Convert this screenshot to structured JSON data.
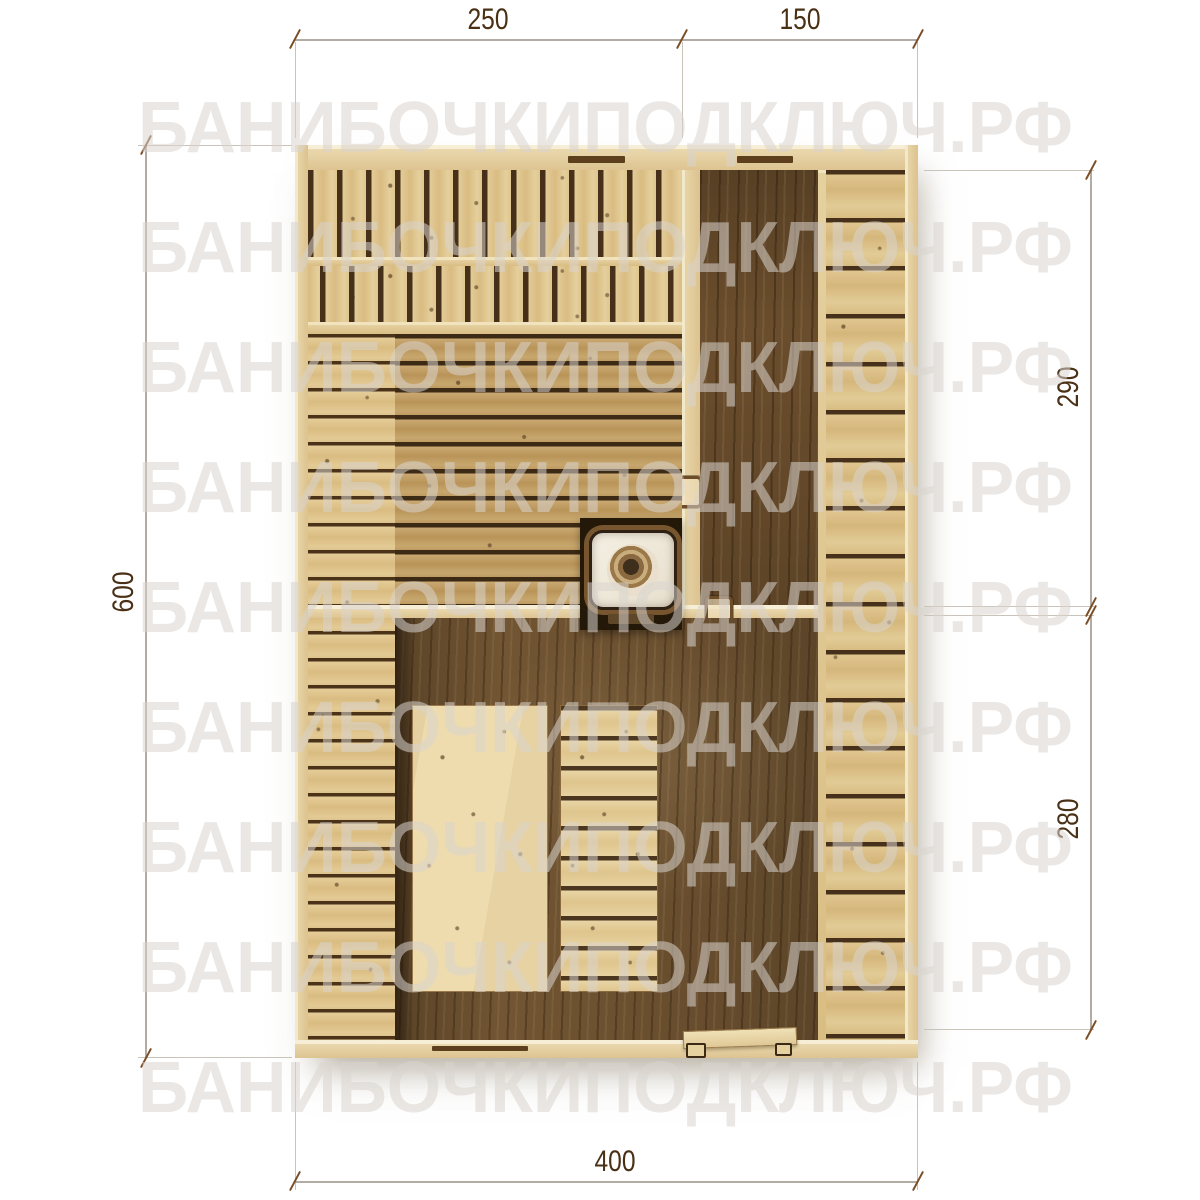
{
  "watermark": {
    "text": "БАНИБОЧКИПОДКЛЮЧ.РФ"
  },
  "dimensions": {
    "top_left": "250",
    "top_right": "150",
    "left": "600",
    "right_upper": "290",
    "right_lower": "280",
    "bottom": "400"
  },
  "colors": {
    "background": "#ffffff",
    "watermark_gray": "#e8e6e2",
    "dimension_line": "#b2aca2",
    "dimension_tick": "#7a4e26",
    "dimension_text": "#4a3015",
    "wall_wood": "#e7d4a6",
    "plank_gap": "#3c2a15",
    "sauna_planks": "#c3a269",
    "light_planks": "#e0c68f",
    "dark_floor": "#6e5330",
    "stove_surround": "#241808",
    "stove_body": "#f0ebdf"
  }
}
